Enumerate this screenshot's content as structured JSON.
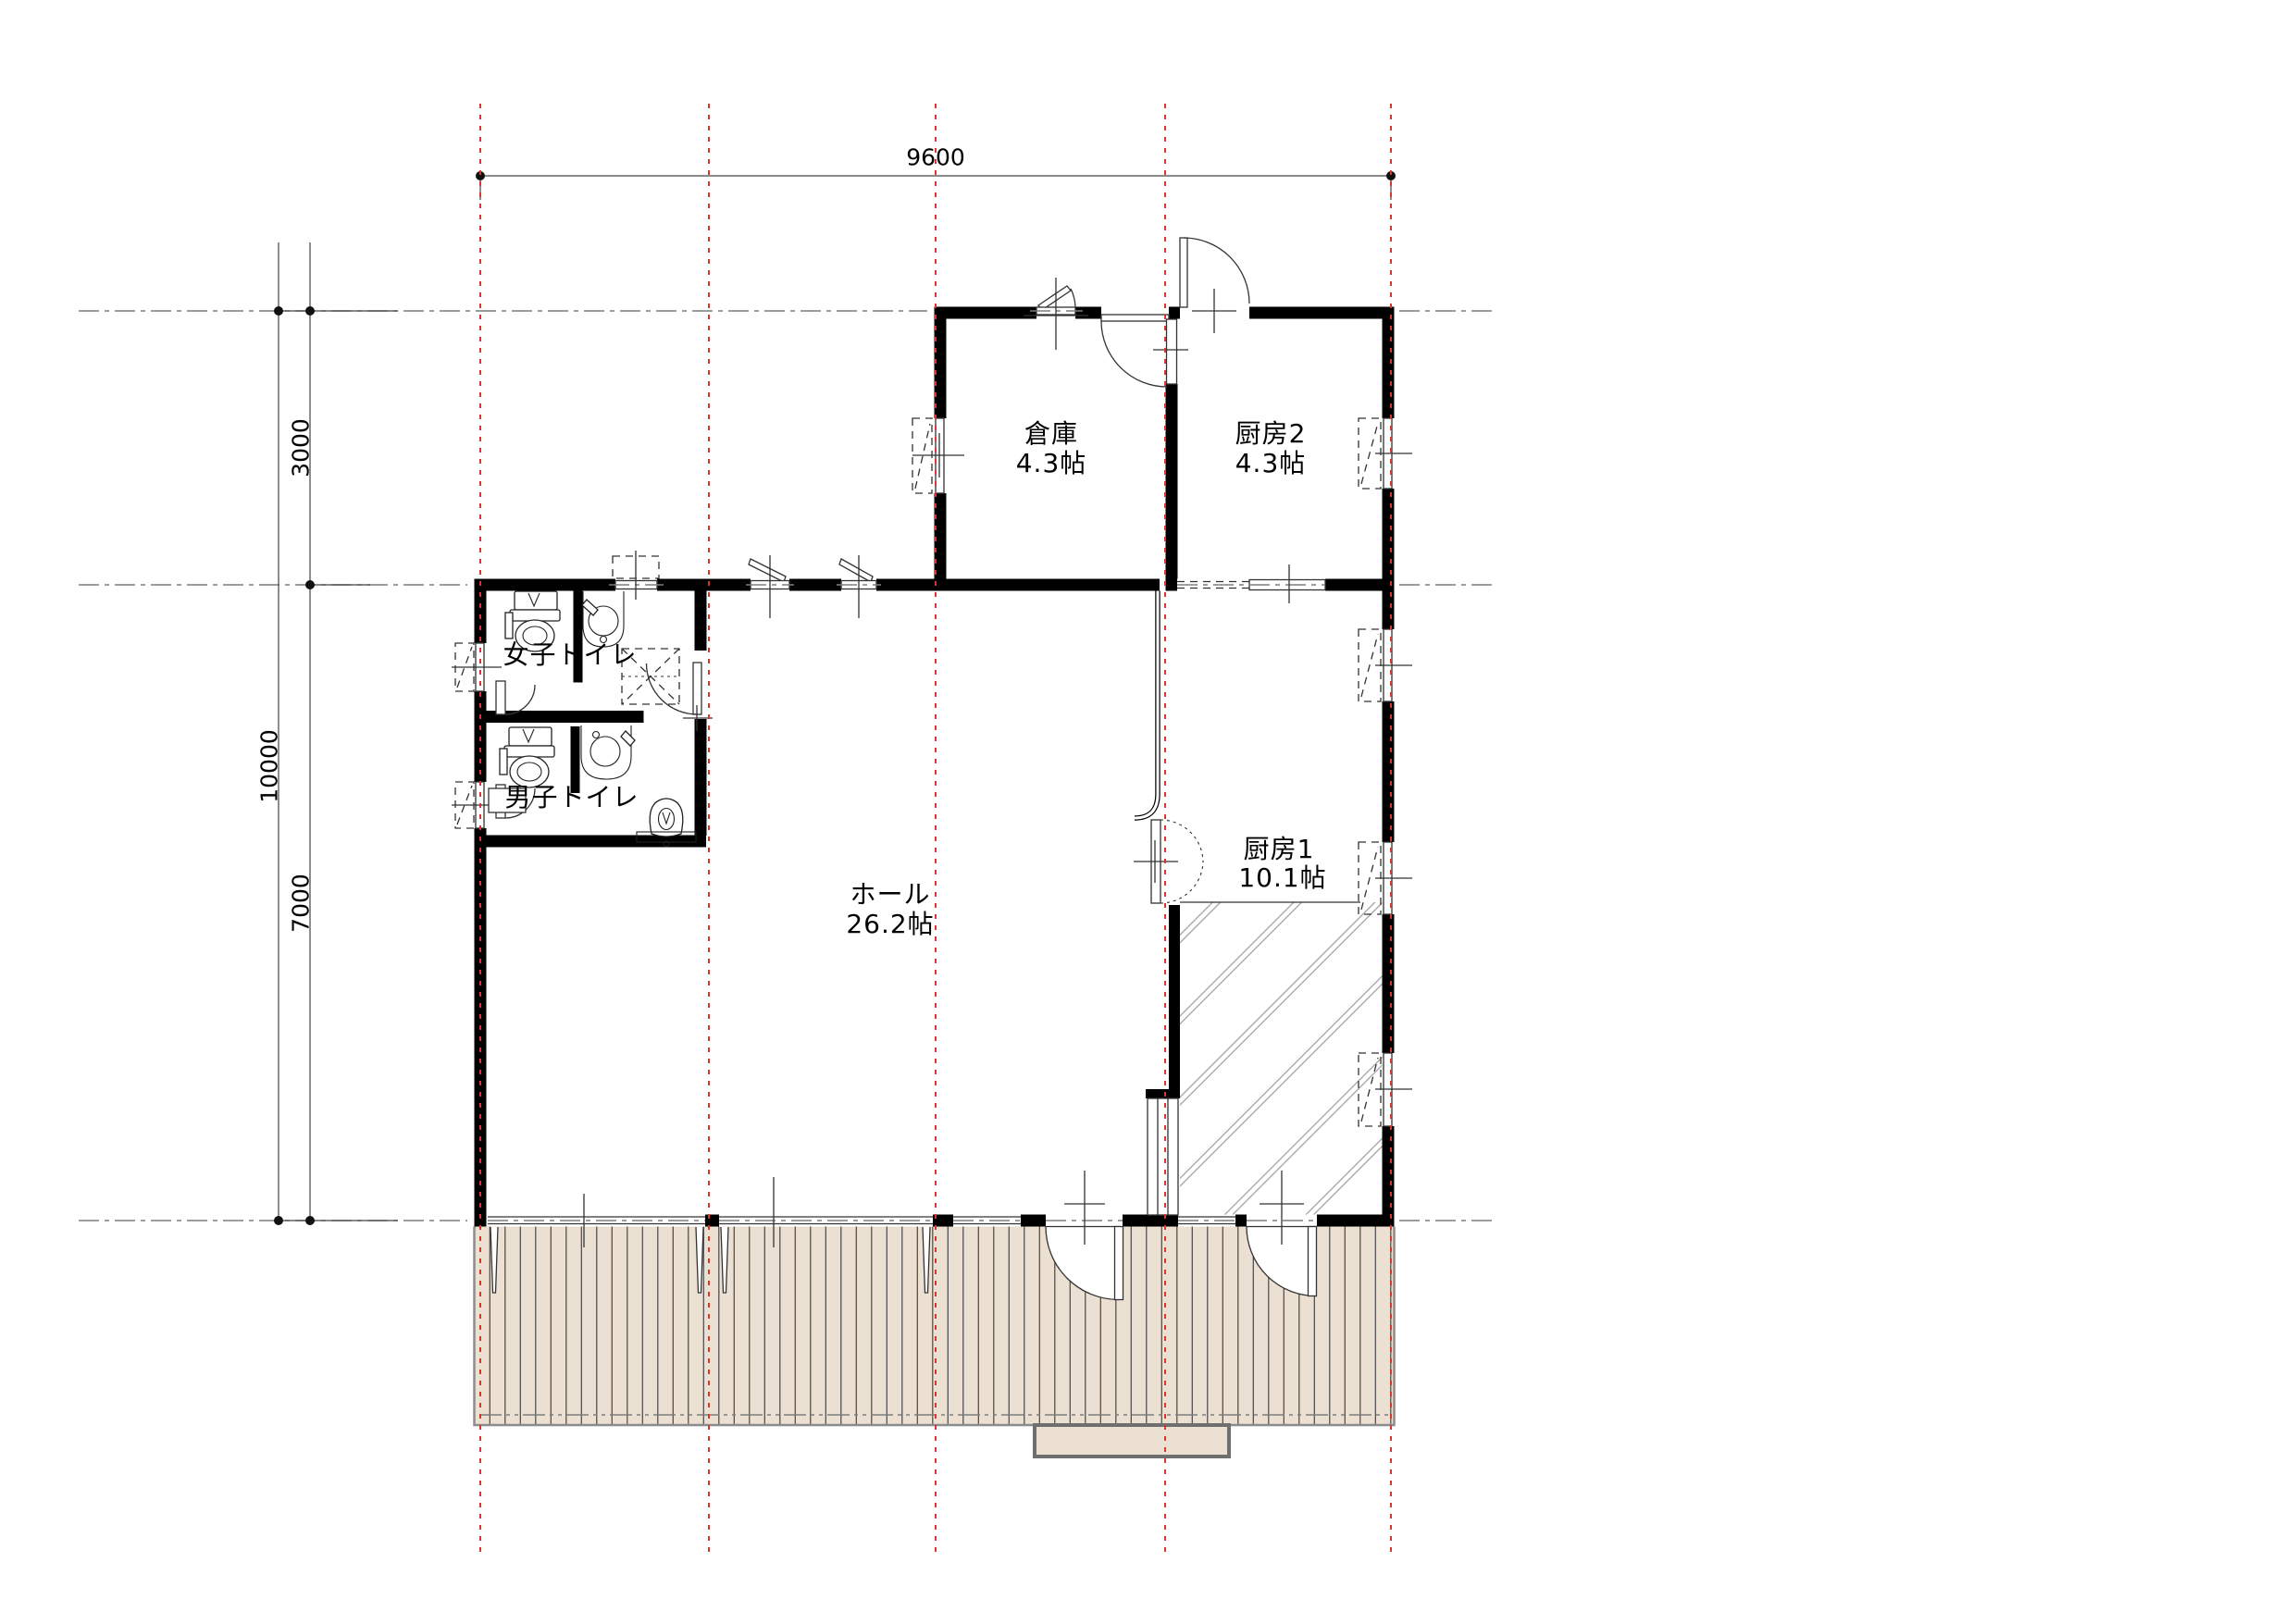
{
  "plan": {
    "title": "floor-plan",
    "dimensions": {
      "top_width": "9600",
      "left_upper": "3000",
      "left_total": "10000",
      "left_lower": "7000"
    },
    "rooms": {
      "storage": {
        "name": "倉庫",
        "area": "4.3帖"
      },
      "kitchen2": {
        "name": "厨房2",
        "area": "4.3帖"
      },
      "kitchen1": {
        "name": "厨房1",
        "area": "10.1帖"
      },
      "hall": {
        "name": "ホール",
        "area": "26.2帖"
      },
      "womens_toilet": {
        "name": "女子トイレ"
      },
      "mens_toilet": {
        "name": "男子トイレ"
      }
    },
    "colors": {
      "wall": "#000000",
      "line": "#333333",
      "grid-red": "#d5372b",
      "grid-gray": "#7d7d7d",
      "deck-fill": "#ece0d3",
      "hatch-line": "#9b9b9b"
    }
  }
}
